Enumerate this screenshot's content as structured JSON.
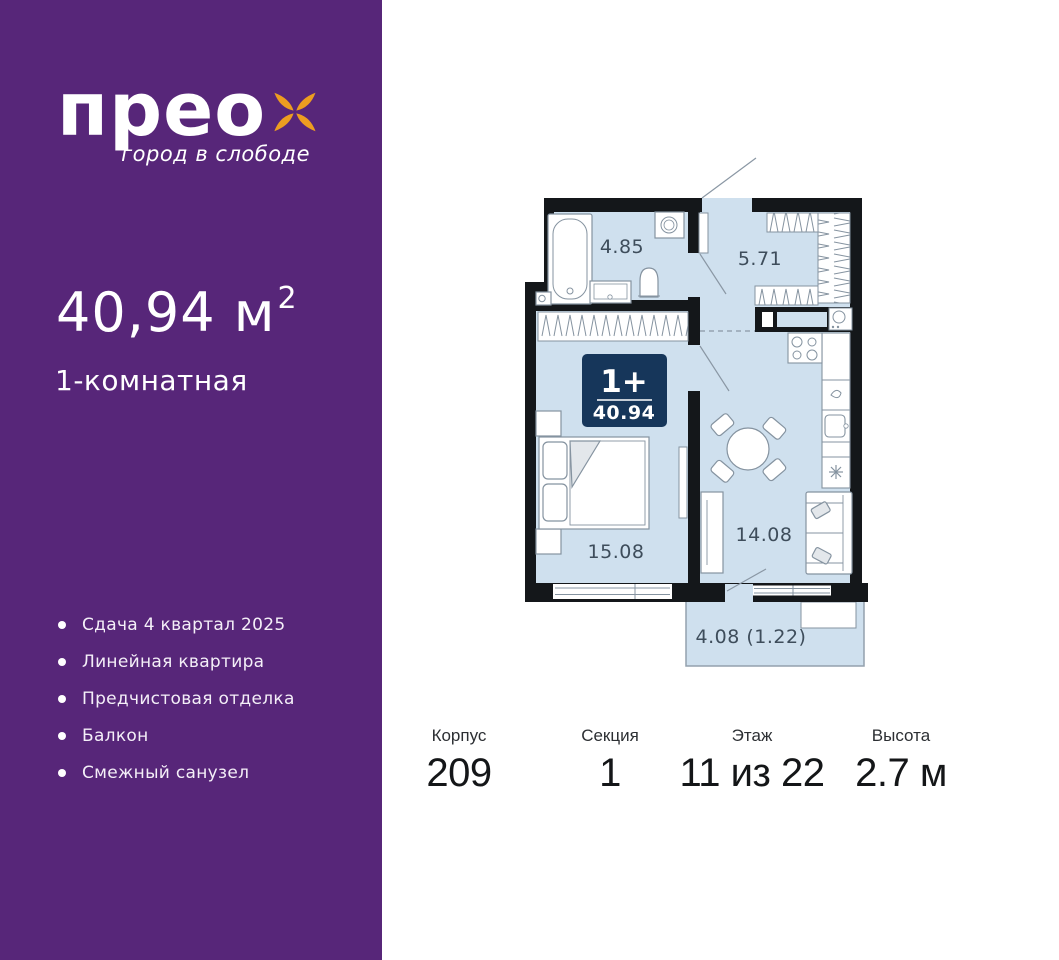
{
  "sidebar": {
    "brand": "прео",
    "tagline": "город в слободе",
    "area_value": "40,94",
    "area_unit": "м",
    "area_sup": "2",
    "rooms_label": "1-комнатная",
    "features": [
      "Сдача 4 квартал 2025",
      "Линейная квартира",
      "Предчистовая отделка",
      "Балкон",
      "Смежный санузел"
    ],
    "colors": {
      "background": "#572679",
      "flower": "#ED9D20",
      "text": "#FFFFFF"
    }
  },
  "plan": {
    "badge": {
      "rooms": "1+",
      "area": "40.94",
      "background": "#16365A"
    },
    "rooms": [
      {
        "id": "bathroom",
        "area": "4.85"
      },
      {
        "id": "hallway",
        "area": "5.71"
      },
      {
        "id": "bedroom",
        "area": "15.08"
      },
      {
        "id": "kitchen_living",
        "area": "14.08"
      },
      {
        "id": "balcony",
        "area": "4.08 (1.22)"
      }
    ],
    "colors": {
      "floor": "#CFE0EE",
      "walls": "#14171A",
      "furniture": "#8593A0",
      "labels": "#3E4D5B"
    }
  },
  "details": {
    "columns": [
      {
        "label": "Корпус",
        "value": "209"
      },
      {
        "label": "Секция",
        "value": "1"
      },
      {
        "label": "Этаж",
        "value": "11 из 22"
      },
      {
        "label": "Высота",
        "value": "2.7 м"
      }
    ]
  }
}
